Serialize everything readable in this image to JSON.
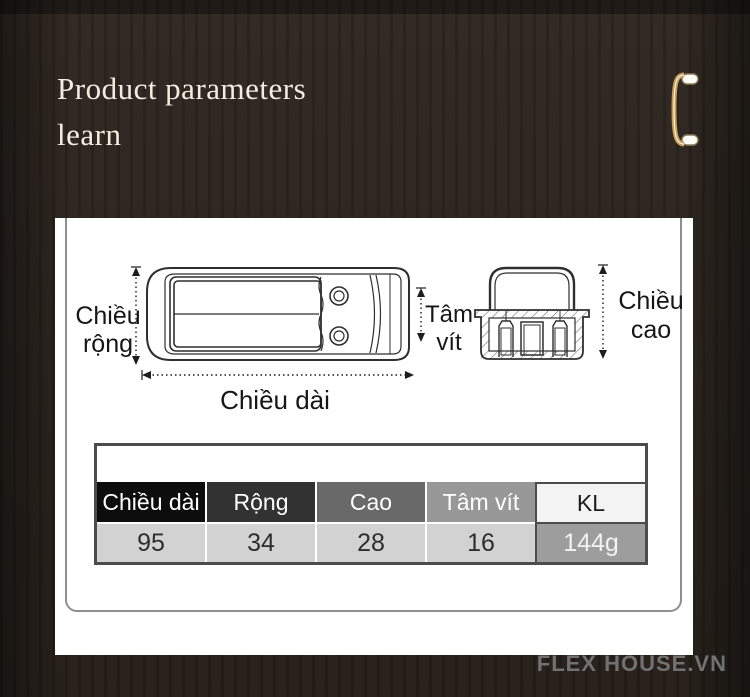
{
  "header": {
    "title_line1": "Product parameters",
    "title_line2": "learn"
  },
  "diagram": {
    "width_label_line1": "Chiều",
    "width_label_line2": "rộng",
    "length_label": "Chiều dài",
    "screw_label_line1": "Tâm",
    "screw_label_line2": "vít",
    "height_label_line1": "Chiều",
    "height_label_line2": "cao"
  },
  "spec_table": {
    "columns": [
      "Chiều dài",
      "Rộng",
      "Cao",
      "Tâm vít",
      "KL"
    ],
    "values": [
      "95",
      "34",
      "28",
      "16",
      "144g"
    ]
  },
  "footer": {
    "watermark": "FLEX HOUSE.VN"
  },
  "colors": {
    "background": "#2b241e",
    "card": "#ffffff",
    "accent_gold": "#c59a55",
    "title_text": "#f2ece1",
    "watermark_text": "#717171",
    "table_header_shades": [
      "#0d0d0d",
      "#323232",
      "#696969",
      "#989898",
      "#f3f3f3"
    ],
    "table_value_bg": "#d2d2d2",
    "table_weight_bg": "#9d9d9d",
    "table_border": "#4c4c4c",
    "drawing_line": "#2f2f2f"
  }
}
